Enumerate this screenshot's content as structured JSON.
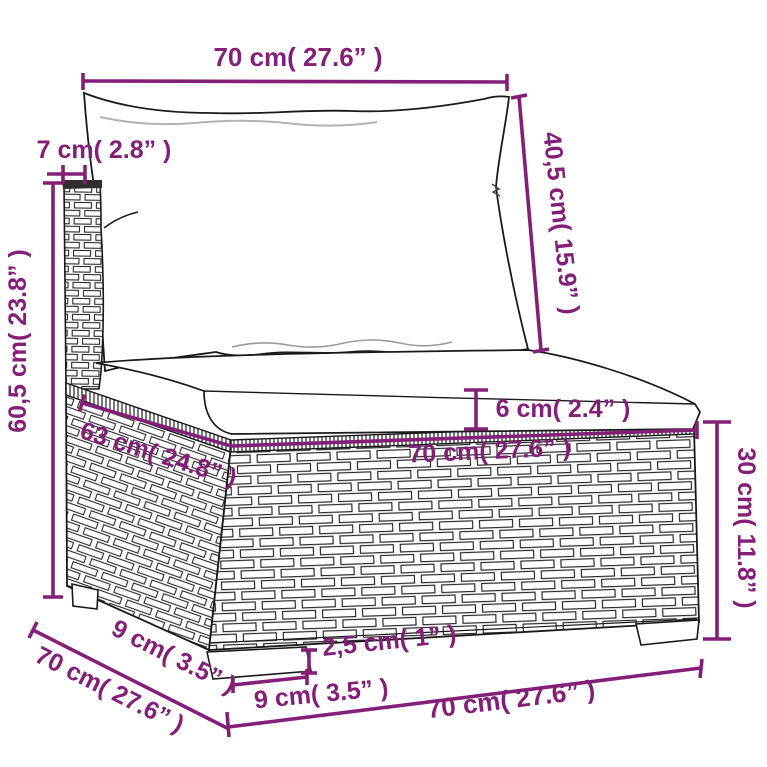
{
  "title": "Sofa section with cushions — dimension diagram",
  "colors": {
    "dimension_accent": "#841f78",
    "sketch_line": "#1a1a1a",
    "background": "#ffffff",
    "shading": "#b3b3b3"
  },
  "dimensions": {
    "back_cushion_width_top": "70 cm( 27.6” )",
    "back_cushion_thickness": "7 cm( 2.8” )",
    "total_height": "60,5 cm( 23.8” )",
    "back_cushion_height": "40,5 cm( 15.9” )",
    "seat_cushion_thickness": "6 cm( 2.4” )",
    "seat_depth": "63 cm( 24.8” )",
    "seat_width": "70 cm( 27.6” )",
    "base_height": "30 cm( 11.8” )",
    "foot_height": "2,5 cm( 1” )",
    "foot_width": "9 cm( 3.5” )",
    "side_foot_depth": "9 cm( 3.5” )",
    "total_depth": "70 cm( 27.6” )",
    "base_width_bottom": "70 cm( 27.6” )"
  }
}
